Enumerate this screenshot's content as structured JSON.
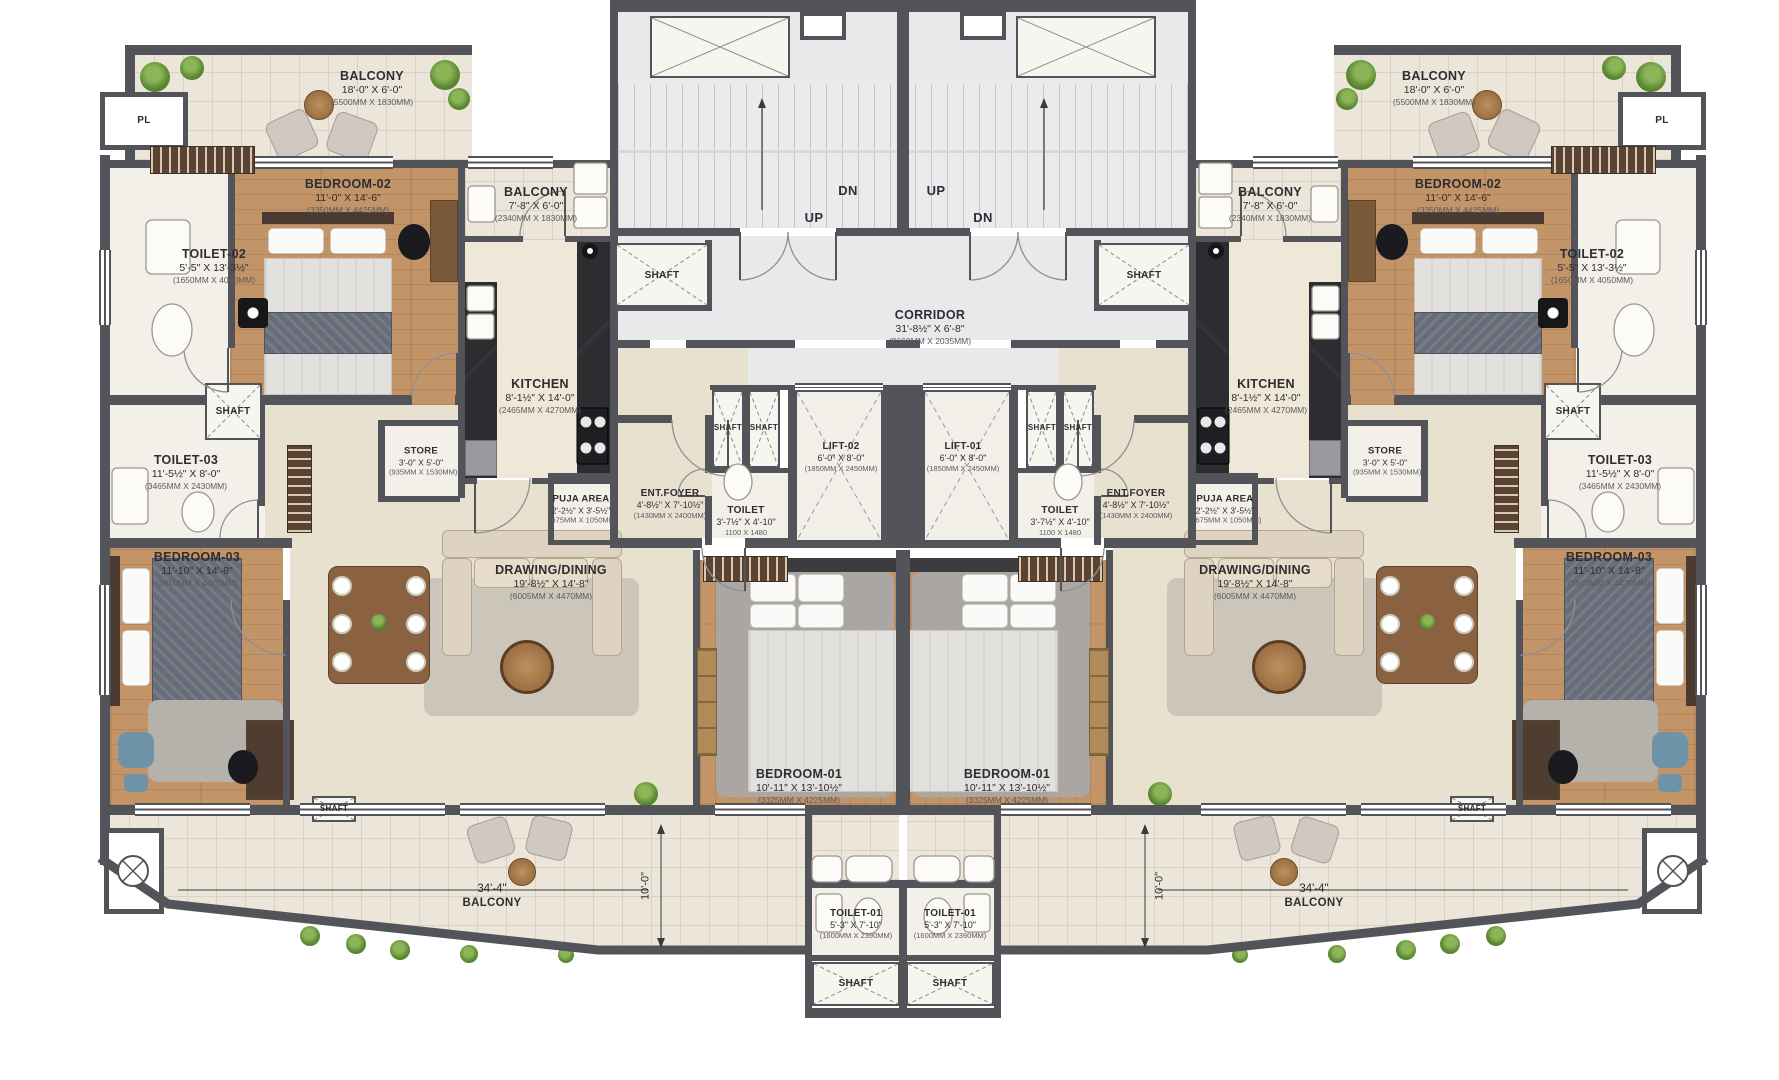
{
  "plan": {
    "rooms": {
      "balcony_top": {
        "name": "BALCONY",
        "dims": "18'-0\" X 6'-0\"",
        "mm": "(5500MM X 1830MM)"
      },
      "bedroom2": {
        "name": "BEDROOM-02",
        "dims": "11'-0\" X 14'-6\"",
        "mm": "(3350MM X 4425MM)"
      },
      "toilet2": {
        "name": "TOILET-02",
        "dims": "5'-5\" X 13'-3½\"",
        "mm": "(1650MM X 4050MM)"
      },
      "toilet3": {
        "name": "TOILET-03",
        "dims": "11'-5½\" X 8'-0\"",
        "mm": "(3465MM X 2430MM)"
      },
      "bedroom3": {
        "name": "BEDROOM-03",
        "dims": "11'-10\" X 14'-8\"",
        "mm": "(3610MM X 4470MM)"
      },
      "balcony_small": {
        "name": "BALCONY",
        "dims": "7'-8\" X 6'-0\"",
        "mm": "(2340MM X 1830MM)"
      },
      "kitchen": {
        "name": "KITCHEN",
        "dims": "8'-1½\" X 14'-0\"",
        "mm": "(2465MM X 4270MM)"
      },
      "store": {
        "name": "STORE",
        "dims": "3'-0\" X 5'-0\"",
        "mm": "(935MM X 1530MM)"
      },
      "puja": {
        "name": "PUJA AREA",
        "dims": "2'-2½\" X 3'-5½\"",
        "mm": "(675MM X 1050MM)"
      },
      "ent_foyer": {
        "name": "ENT.FOYER",
        "dims": "4'-8½\" X 7'-10½\"",
        "mm": "(1430MM X 2400MM)"
      },
      "drawing_dining": {
        "name": "DRAWING/DINING",
        "dims": "19'-8½\" X 14'-8\"",
        "mm": "(6005MM X 4470MM)"
      },
      "bedroom1": {
        "name": "BEDROOM-01",
        "dims": "10'-11\" X 13'-10½\"",
        "mm": "(3325MM X 4225MM)"
      },
      "toilet_core": {
        "name": "TOILET",
        "dims": "3'-7½\" X 4'-10\"",
        "mm": "1100 X 1480"
      },
      "toilet1": {
        "name": "TOILET-01",
        "dims": "5'-3\" X 7'-10\"",
        "mm": "(1600MM X 2390MM)"
      },
      "lift1": {
        "name": "LIFT-01",
        "dims": "6'-0\" X 8'-0\"",
        "mm": "(1850MM X 2450MM)"
      },
      "lift2": {
        "name": "LIFT-02",
        "dims": "6'-0\" X 8'-0\"",
        "mm": "(1850MM X 2450MM)"
      },
      "corridor": {
        "name": "CORRIDOR",
        "dims": "31'-8½\" X 6'-8\"",
        "mm": "(9660MM X 2035MM)"
      },
      "shaft": {
        "name": "SHAFT"
      },
      "pl": {
        "name": "PL"
      }
    },
    "stairs": {
      "up": "UP",
      "dn": "DN"
    },
    "balcony_bottom": {
      "name": "BALCONY",
      "width_dim": "34'-4\"",
      "depth_dim": "10'-0\""
    },
    "colors": {
      "wall": "#53545a",
      "wood": "#c29468",
      "tile": "#ece6da",
      "beige": "#e9e1d0",
      "dark_counter": "#27272c",
      "core_floor": "#e9e9ec",
      "accent_green": "#5d8a33",
      "accent_blue": "#6e93a8"
    }
  }
}
